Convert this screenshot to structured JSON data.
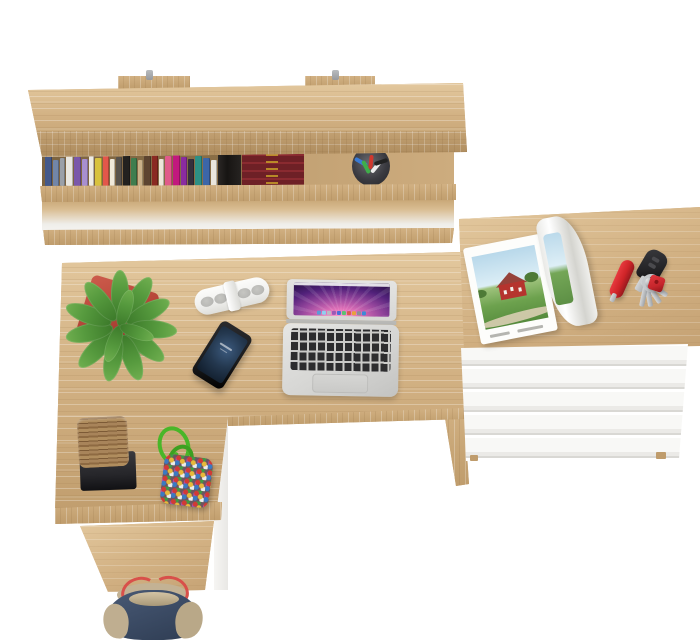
{
  "meta": {
    "title": "Top-down 3D render of a home office corner: wall shelf with books, L-shaped oak desk and white chest of drawers",
    "visible_text": "none"
  },
  "palette": {
    "bg": "#ffffff",
    "wood": "#d2b183",
    "woodLight": "#e3c89e",
    "woodDark": "#bf9c6c",
    "woodDark2": "#c5a274",
    "woodEdge": "#c6a474",
    "metal": "#97999c",
    "stackMaroon": "#6e2026",
    "stackGold": "#c9a227",
    "potRed": "#b8473a",
    "leafGreen": "#569a3e",
    "leafDark": "#3c7a2a",
    "bagRed": "#c8443a",
    "bagHandle": "#2c3550",
    "stripWhite": "#f1f1ef",
    "stripGrille": "#b7b7b4",
    "phoneBlack": "#1b1c1e",
    "phoneScreenA": "#3c5a7e",
    "phoneScreenB": "#101c2a",
    "laptopSilver": "#d6d6d4",
    "keyBlack": "#2d2d2f",
    "trackpad": "#c9c9c7",
    "wallB": "#94459c",
    "wallC": "#1e0d38",
    "pageWhite": "#fdfdfb",
    "sky": "#b8d8ea",
    "grass": "#6da24e",
    "barnRed": "#b5342e",
    "roof": "#96423a",
    "road": "#d9ceb2",
    "knifeRed": "#cf2428",
    "fobBlack": "#232326",
    "keySilver": "#c6c9cc",
    "tagRed": "#c6262c",
    "blockWood": "#a8845a",
    "trayBlack": "#26262a",
    "cordGreen": "#49b629",
    "pouchBase": "#6b5560",
    "toteNavy": "#3e4e68",
    "toteTan": "#bfae90",
    "toteRed": "#d8504a"
  },
  "shelf": {
    "row1_spines": [
      {
        "c": "#44598a",
        "w": 7,
        "h": 30
      },
      {
        "c": "#7286a8",
        "w": 6,
        "h": 26
      },
      {
        "c": "#9aa0a8",
        "w": 5,
        "h": 28
      },
      {
        "c": "#e9e7e0",
        "w": 7,
        "h": 31
      },
      {
        "c": "#7a58aa",
        "w": 7,
        "h": 29
      },
      {
        "c": "#a88fd0",
        "w": 6,
        "h": 27
      },
      {
        "c": "#efece4",
        "w": 5,
        "h": 30
      },
      {
        "c": "#d8c23e",
        "w": 7,
        "h": 28
      },
      {
        "c": "#e3574a",
        "w": 6,
        "h": 33
      },
      {
        "c": "#f0e9da",
        "w": 5,
        "h": 27
      },
      {
        "c": "#58524c",
        "w": 6,
        "h": 29
      },
      {
        "c": "#23211f",
        "w": 7,
        "h": 31
      },
      {
        "c": "#3f7d4e",
        "w": 6,
        "h": 28
      },
      {
        "c": "#c9b088",
        "w": 5,
        "h": 26
      },
      {
        "c": "#5d4430",
        "w": 7,
        "h": 30
      },
      {
        "c": "#8a2a22",
        "w": 6,
        "h": 32
      },
      {
        "c": "#ece6da",
        "w": 5,
        "h": 27
      },
      {
        "c": "#e05a8a",
        "w": 7,
        "h": 30
      },
      {
        "c": "#c2187e",
        "w": 7,
        "h": 33
      },
      {
        "c": "#8a2ba0",
        "w": 6,
        "h": 29
      },
      {
        "c": "#352f3d",
        "w": 6,
        "h": 27
      },
      {
        "c": "#2d8f85",
        "w": 7,
        "h": 30
      },
      {
        "c": "#3c66a8",
        "w": 7,
        "h": 28
      },
      {
        "c": "#eae6dd",
        "w": 6,
        "h": 26
      }
    ],
    "row2_spines": [
      {
        "c": "#efece7",
        "w": 7,
        "h": 29
      },
      {
        "c": "#8f2b2b",
        "w": 6,
        "h": 31
      },
      {
        "c": "#d4552e",
        "w": 6,
        "h": 27
      },
      {
        "c": "#4d8f3e",
        "w": 7,
        "h": 29
      },
      {
        "c": "#2f9e8f",
        "w": 6,
        "h": 30
      },
      {
        "c": "#1f6e66",
        "w": 6,
        "h": 26
      },
      {
        "c": "#f1efe9",
        "w": 6,
        "h": 28
      },
      {
        "c": "#4a342a",
        "w": 7,
        "h": 30
      },
      {
        "c": "#211d1b",
        "w": 8,
        "h": 31
      },
      {
        "c": "#7e1f1f",
        "w": 6,
        "h": 27
      },
      {
        "c": "#efece7",
        "w": 6,
        "h": 25
      },
      {
        "c": "#d8387e",
        "w": 7,
        "h": 29
      },
      {
        "c": "#ece5d8",
        "w": 5,
        "h": 26
      },
      {
        "c": "#f2efe8",
        "w": 6,
        "h": 28
      },
      {
        "c": "#1b1917",
        "w": 7,
        "h": 30
      },
      {
        "c": "#2c3a6e",
        "w": 7,
        "h": 29
      },
      {
        "c": "#efeadf",
        "w": 5,
        "h": 25
      },
      {
        "c": "#c23b2e",
        "w": 6,
        "h": 28
      },
      {
        "c": "#3c66a8",
        "w": 7,
        "h": 30
      },
      {
        "c": "#e0a23a",
        "w": 6,
        "h": 26
      },
      {
        "c": "#c9a87a",
        "w": 6,
        "h": 24
      }
    ],
    "pens": [
      "#3a7bd5",
      "#3fae4a",
      "#d0382e",
      "#ececec",
      "#222222"
    ]
  },
  "laptop": {
    "dock_icons": [
      "#5a9bd8",
      "#8ed0f0",
      "#b8bcc2",
      "#9b59b6",
      "#4a6fd8",
      "#58c470",
      "#d85a50",
      "#e8a23a",
      "#8a8f96",
      "#3a8ad8"
    ]
  },
  "objects": [
    {
      "name": "wall-shelf",
      "desc": "oak wall shelf with two rows of books"
    },
    {
      "name": "stacked-leather-books",
      "desc": "maroon leather books with gold tooling"
    },
    {
      "name": "pen-cup",
      "desc": "dark cup with colored pens"
    },
    {
      "name": "cactus-pot",
      "desc": "white round pot with cactus"
    },
    {
      "name": "red-handbag",
      "desc": "red bag with navy handles"
    },
    {
      "name": "black-speaker",
      "desc": "black speaker on lower shelf"
    },
    {
      "name": "desk",
      "desc": "L-shaped light oak desk"
    },
    {
      "name": "plant",
      "desc": "green bromeliad in red square pot"
    },
    {
      "name": "portable-speaker",
      "desc": "white pill speaker with clip"
    },
    {
      "name": "smartphone",
      "desc": "black phone, blue lock screen"
    },
    {
      "name": "laptop",
      "desc": "silver laptop, purple aurora wallpaper with dock"
    },
    {
      "name": "drawer-unit",
      "desc": "oak-top chest with white drawers"
    },
    {
      "name": "magazine",
      "desc": "open magazine, red barn in green field"
    },
    {
      "name": "pocket-knife",
      "desc": "red pocket knife"
    },
    {
      "name": "car-key-fob",
      "desc": "black car key"
    },
    {
      "name": "key-bunch",
      "desc": "keys on ring with red tag"
    },
    {
      "name": "wood-blocks",
      "desc": "stack of rough wooden blocks on black tray"
    },
    {
      "name": "bead-pouch",
      "desc": "multicolor beaded pouch with green cord"
    },
    {
      "name": "tote-bag",
      "desc": "navy tote with red straps on floor"
    }
  ]
}
